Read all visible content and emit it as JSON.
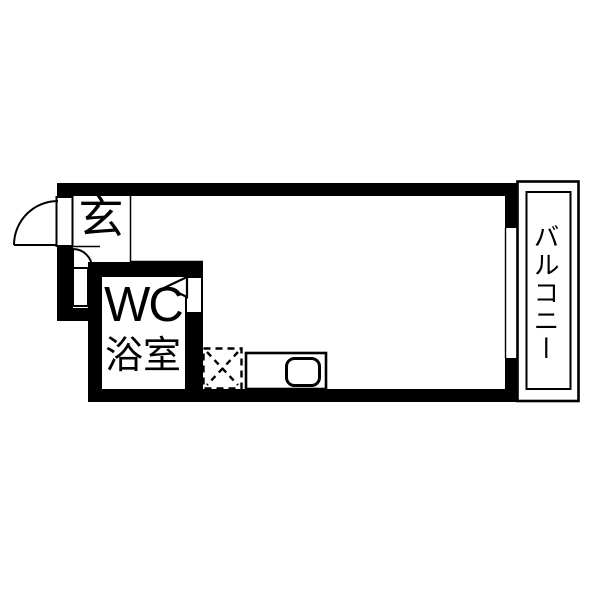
{
  "floorplan": {
    "background_color": "#ffffff",
    "wall_color": "#000000",
    "line_color": "#000000",
    "labels": {
      "entrance": "玄",
      "wc": "WC",
      "bathroom": "浴室",
      "balcony": "バルコニー"
    },
    "rooms": [
      {
        "name": "entrance",
        "label": "玄"
      },
      {
        "name": "wc-bathroom",
        "label": "WC 浴室"
      },
      {
        "name": "main-room",
        "label": ""
      },
      {
        "name": "balcony",
        "label": "バルコニー"
      }
    ],
    "fixtures": [
      "entrance-door-swing",
      "interior-door-swing",
      "wc-folding-door-indicator",
      "washing-machine-pan",
      "kitchen-counter",
      "kitchen-sink",
      "balcony-window-opening"
    ]
  }
}
